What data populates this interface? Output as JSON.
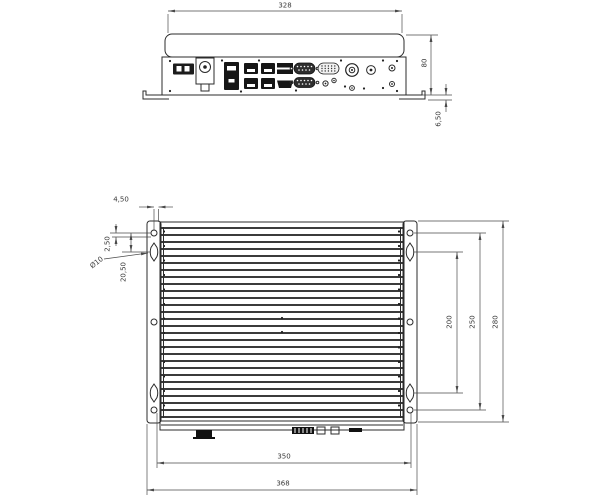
{
  "drawing": {
    "type": "mechanical-dimension-drawing",
    "line_color": "#2b2b2b",
    "dim_color": "#4a4a4a",
    "fin_count": 27
  },
  "top_view": {
    "name": "rear-panel-view",
    "dims": {
      "width": "328",
      "height": "80",
      "bracket_offset": "6,50"
    },
    "ports": [
      "power-terminal-block",
      "power-button",
      "lan-port",
      "usb-port-1",
      "usb-port-2",
      "usb-port-3",
      "usb-port-4",
      "display-port-1",
      "display-port-2",
      "hdmi-port",
      "serial-com1",
      "serial-com2",
      "vga-port",
      "antenna-connector",
      "audio-jack-1",
      "audio-jack-2",
      "dc-jack",
      "led-indicator-1",
      "led-indicator-2"
    ]
  },
  "bottom_view": {
    "name": "heatsink-top-view",
    "dims": {
      "edge_offset": "4,50",
      "slot_offset": "2,50",
      "keyhole_length": "20,50",
      "hole_diameter": "Ø10",
      "slot_pitch": "200",
      "hole_pitch_vertical": "250",
      "bracket_height": "280",
      "hole_pitch_horizontal": "350",
      "overall_width": "368"
    }
  }
}
